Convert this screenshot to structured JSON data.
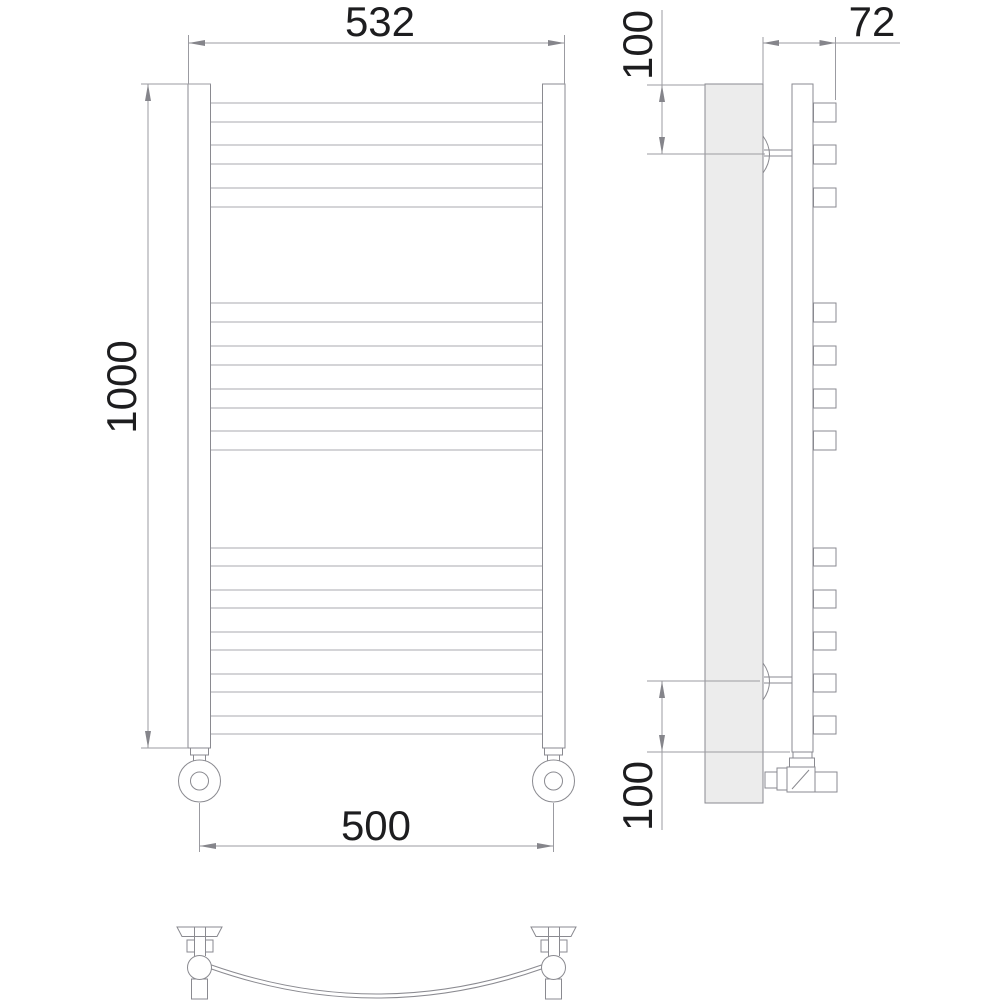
{
  "drawing": {
    "kind": "technical drawing",
    "subject": "wall-mounted ladder towel rail, three orthographic views",
    "background": "#ffffff",
    "colors": {
      "line": "#8a8a90",
      "rung_line": "#a9a9af",
      "dimension_line": "#9b9ba1",
      "arrow": "#85858b",
      "text": "#1d1d1f",
      "wall_plate_fill": "#ececec"
    },
    "dimensions": {
      "top_width": "532",
      "height": "1000",
      "bottom_width": "500",
      "depth": "72",
      "top_bracket_offset": "100",
      "bottom_bracket_offset": "100"
    },
    "front_view": {
      "rung_count": 12,
      "rung_groups": [
        3,
        4,
        5
      ],
      "rungs": [
        [
          103,
          122
        ],
        [
          145,
          164
        ],
        [
          188,
          207
        ],
        [
          303,
          322
        ],
        [
          346,
          365
        ],
        [
          389,
          408
        ],
        [
          431,
          450
        ],
        [
          548,
          566
        ],
        [
          590,
          608
        ],
        [
          632,
          650
        ],
        [
          674,
          692
        ],
        [
          716,
          734
        ]
      ]
    },
    "side_view": {
      "bracket_count": 2,
      "bracket_centers_y": [
        154,
        681
      ]
    },
    "plan_view": {
      "shape": "curved crossbar between two posts"
    }
  }
}
